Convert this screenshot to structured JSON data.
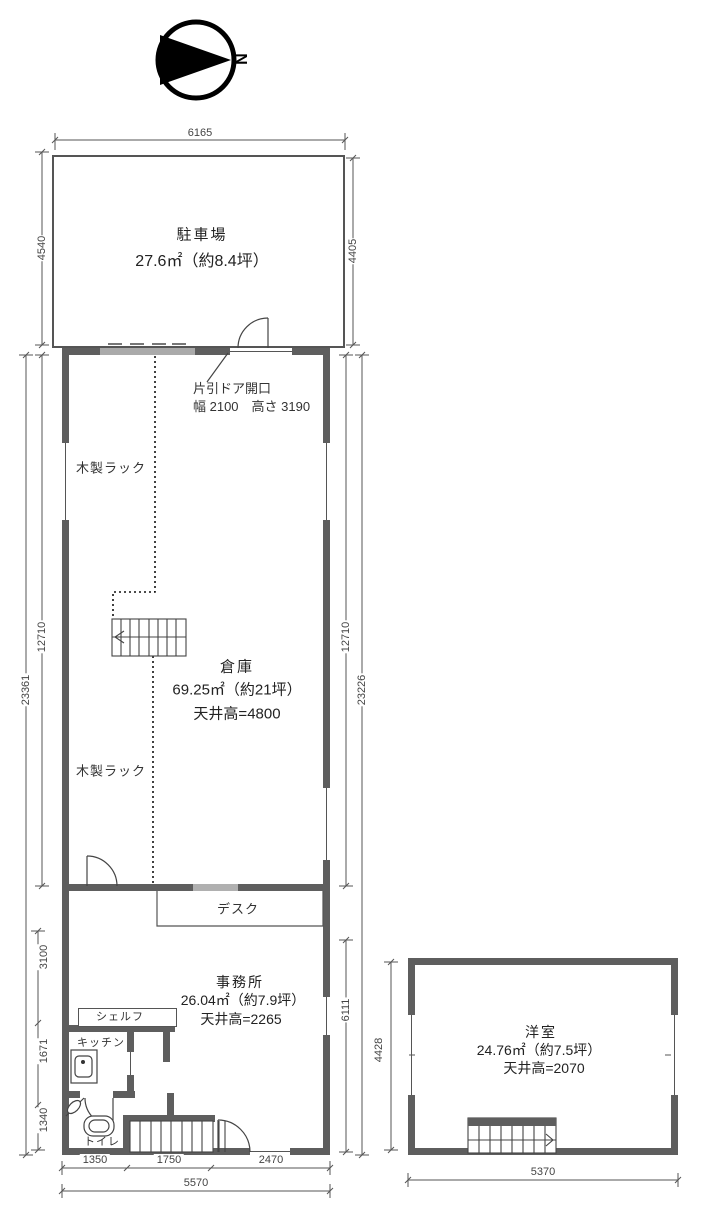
{
  "compass": {
    "north": "N"
  },
  "rooms": {
    "parking": {
      "name": "駐車場",
      "area": "27.6㎡（約8.4坪）"
    },
    "warehouse": {
      "name": "倉庫",
      "area": "69.25㎡（約21坪）",
      "ceiling": "天井高=4800"
    },
    "office": {
      "name": "事務所",
      "area": "26.04㎡（約7.9坪）",
      "ceiling": "天井高=2265"
    },
    "western": {
      "name": "洋室",
      "area": "24.76㎡（約7.5坪）",
      "ceiling": "天井高=2070"
    }
  },
  "labels": {
    "rack_upper": "木製ラック",
    "rack_lower": "木製ラック",
    "door_note_line1": "片引ドア開口",
    "door_note_line2": "幅 2100　高さ 3190",
    "desk": "デスク",
    "shelf": "シェルフ",
    "kitchen": "キッチン",
    "toilet": "トイレ"
  },
  "dims": {
    "top_width": "6165",
    "parking_left": "4540",
    "parking_right": "4405",
    "warehouse_left": "12710",
    "left_total": "23361",
    "warehouse_right": "12710",
    "right_total": "23226",
    "office_left_a": "3100",
    "office_left_b": "1671",
    "office_left_c": "1340",
    "office_right": "6111",
    "western_left": "4428",
    "bottom_a": "1350",
    "bottom_b": "1750",
    "bottom_c": "2470",
    "bottom_total": "5570",
    "western_bottom": "5370"
  },
  "colors": {
    "wall": "#5e5e5e",
    "line": "#555555",
    "text": "#333333"
  }
}
